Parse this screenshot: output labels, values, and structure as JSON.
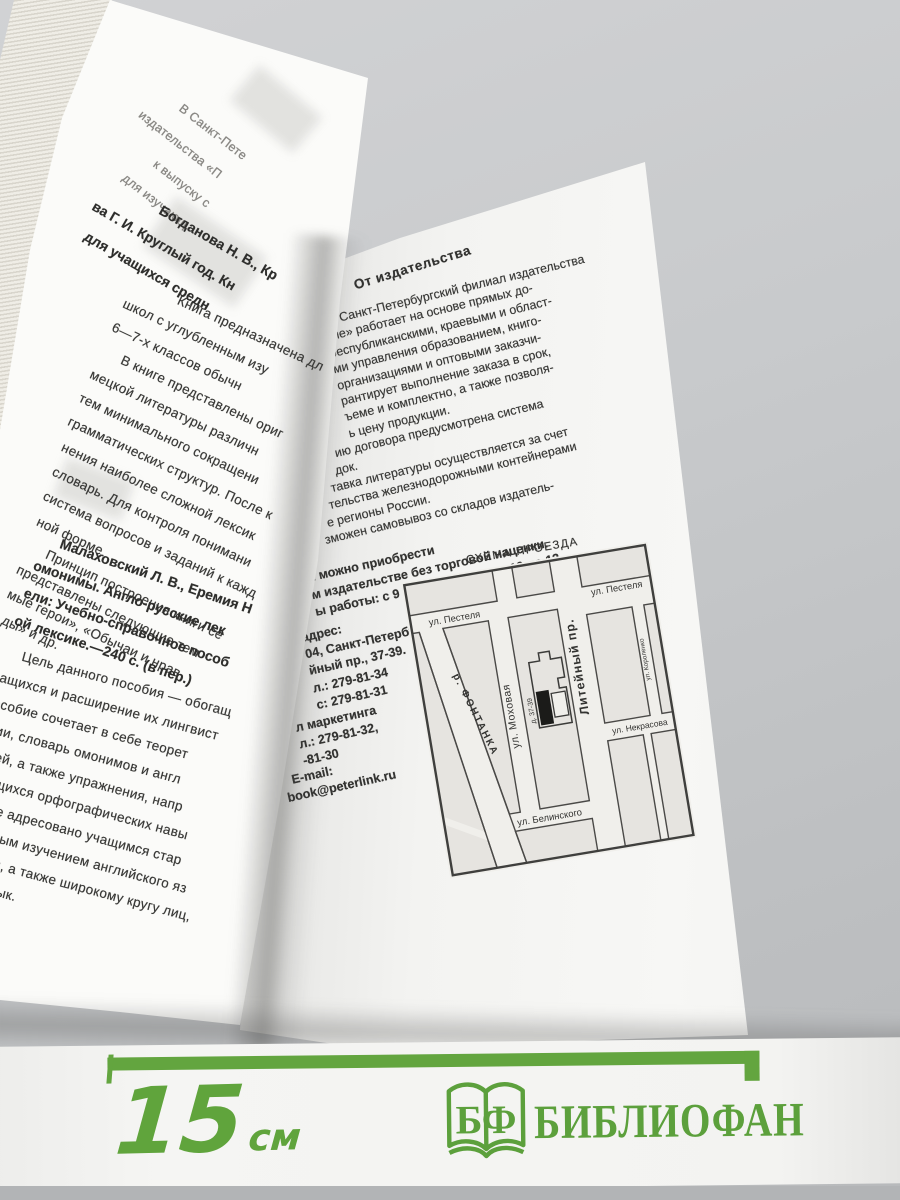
{
  "colors": {
    "accent_green": "#5ea23e",
    "ink": "#3a3a38"
  },
  "left_page": {
    "faded_header_lines": [
      "В Санкт-Пете",
      "издательства «П",
      "к выпуску с",
      "для изучающ"
    ],
    "entry1_heading_lines": [
      "Богданова Н. В., Кр",
      "ва Г. И. Круглый год. Кн",
      "для учащихся средн"
    ],
    "entry1_body_lines": [
      "Книга предназначена дл",
      "школ с углубленным изу",
      "6—7-х классов обычн",
      "В книге представлены ориг",
      "мецкой литературы различн",
      "тем минимального сокращени",
      "грамматических структур. После к",
      "нения наиболее сложной лексик",
      "словарь. Для контроля понимани",
      "система вопросов и заданий к кажд",
      "ной форме.",
      "Принцип построения книги се",
      "представлены следующие тем",
      "мые герои», «Обычаи и нрав",
      "ды» и др."
    ],
    "entry2_heading_lines": [
      "Малаховский Л. В., Еремия Н",
      "омонимы. Англо-русские лек",
      "ели: Учебно-справочное пособ",
      "ой лексике.—240 с. (в пер.)"
    ],
    "entry2_body_lines": [
      "Цель данного пособия — обогащ",
      "ащихся и расширение их лингвист",
      "особие сочетает в себе теорет",
      "мии, словарь омонимов и англ",
      "елей, а также упражнения, напр",
      "учащихся орфографических навы",
      "бие адресовано учащимся стар",
      "нным изучением английского яз",
      "м, а также широкому кругу лиц,",
      "ык."
    ]
  },
  "right_page": {
    "section_title": "От издательства",
    "para1_lines": [
      "Санкт-Петербургский филиал издательства",
      "ние» работает на основе прямых до-",
      "республиканскими, краевыми и област-",
      "ми управления образованием, книго-",
      "организациями и оптовыми заказчи-",
      "рантирует выполнение заказа в срок,",
      "ъеме и комплектно, а также позволя-",
      "ь цену продукции.",
      "ию договора предусмотрена система",
      "док.",
      "тавка литературы осуществляется за счет",
      "тельства железнодорожными контейнерами",
      "е регионы России.",
      "зможен самовывоз со складов издатель-"
    ],
    "purchase_lines": [
      "и можно приобрести",
      "м издательстве без торговой наценки.",
      "ы работы: с 9 до 17, перерыв с 12 до 13."
    ],
    "address_lines": [
      "адрес:",
      "04, Санкт-Петербург,",
      "йный пр., 37-39.",
      "л.: 279-81-34",
      "с: 279-81-31"
    ],
    "marketing_lines": [
      "л маркетинга",
      "л.: 279-81-32,",
      "-81-30"
    ],
    "email_label": "E-mail:",
    "email_value": "book@peterlink.ru",
    "map": {
      "title": "СХЕМА ПРОЕЗДА",
      "pestelya_left": "ул. Пестеля",
      "pestelya_right": "ул. Пестеля",
      "mokhovaya": "ул. Моховая",
      "liteyny": "Литейный пр.",
      "korolenko": "ул. Короленко",
      "nekrasova": "ул. Некрасова",
      "belinskogo": "ул. Белинского",
      "fontanka": "р. ФОНТАНКА",
      "building": "д. 37-39"
    }
  },
  "ruler": {
    "value": "15",
    "unit": "см"
  },
  "logo": {
    "icon": "open-book-icon",
    "monogram": "БФ",
    "name": "БИБЛИОФАН"
  }
}
